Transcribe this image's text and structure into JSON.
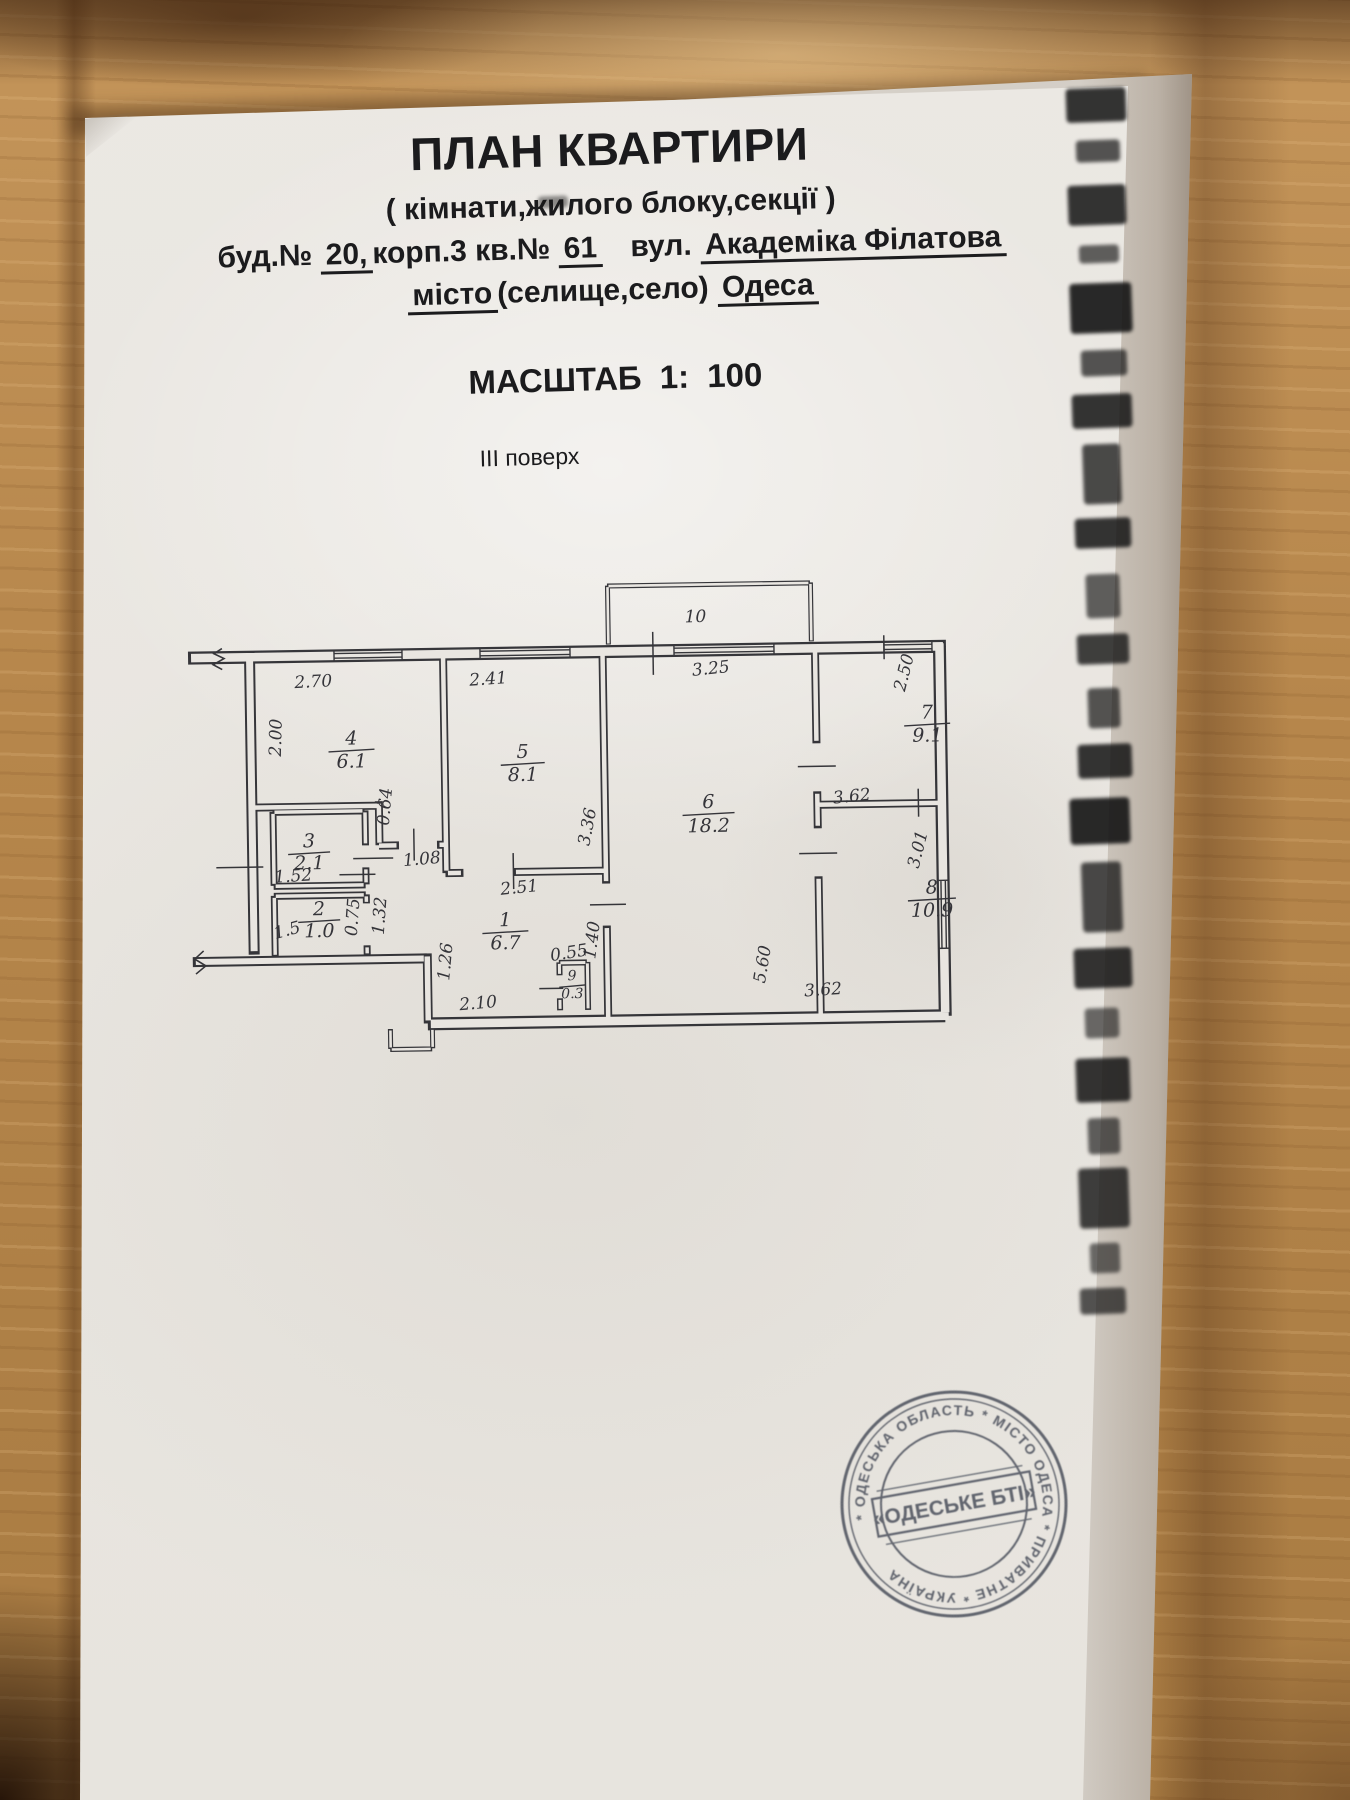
{
  "page": {
    "title": "ПЛАН КВАРТИРИ",
    "subtitle": "( кімнати,жилого блоку,секції )",
    "scale_label": "МАСШТАБ 1: 100",
    "floor_label": "ІІІ поверх"
  },
  "address": {
    "bud_label": "буд.№",
    "house": "20,",
    "building": "корп.3",
    "apt_label": "кв.№",
    "apt": "61",
    "street_label": "вул.",
    "street": "Академіка Філатова",
    "city_label": "місто",
    "city_paren": "(селище,село)",
    "city": "Одеса"
  },
  "plan": {
    "rooms": [
      {
        "number": "1",
        "area": "6.7",
        "x": 503,
        "y": 925,
        "bw": 46,
        "gap": 23
      },
      {
        "number": "2",
        "area": "1.0",
        "x": 317,
        "y": 911,
        "bw": 42,
        "gap": 22
      },
      {
        "number": "3",
        "area": "2.1",
        "x": 308,
        "y": 843,
        "bw": 42,
        "gap": 22
      },
      {
        "number": "4",
        "area": "6.1",
        "x": 352,
        "y": 741,
        "bw": 46,
        "gap": 23
      },
      {
        "number": "5",
        "area": "8.1",
        "x": 523,
        "y": 757,
        "bw": 44,
        "gap": 23
      },
      {
        "number": "6",
        "area": "18.2",
        "x": 708,
        "y": 810,
        "bw": 52,
        "gap": 24
      },
      {
        "number": "7",
        "area": "9.1",
        "x": 928,
        "y": 724,
        "bw": 46,
        "gap": 23
      },
      {
        "number": "8",
        "area": "10.9",
        "x": 930,
        "y": 899,
        "bw": 48,
        "gap": 23
      },
      {
        "number": "9",
        "area": "0.3",
        "x": 569,
        "y": 980,
        "bw": 26,
        "gap": 18,
        "fs": 14
      },
      {
        "number": "10",
        "area": null,
        "x": 698,
        "y": 624,
        "fs": 17
      }
    ],
    "dim_labels": [
      {
        "text": "2.70",
        "x": 315,
        "y": 683,
        "r": -2
      },
      {
        "text": "2.41",
        "x": 490,
        "y": 683,
        "r": -3
      },
      {
        "text": "3.25",
        "x": 713,
        "y": 676,
        "r": -5
      },
      {
        "text": "2.00",
        "x": 282,
        "y": 733,
        "r": -88
      },
      {
        "text": "0.64",
        "x": 390,
        "y": 804,
        "r": -84
      },
      {
        "text": "1.08",
        "x": 421,
        "y": 862,
        "r": -4
      },
      {
        "text": "1.52",
        "x": 292,
        "y": 877,
        "r": -3
      },
      {
        "text": "1.5",
        "x": 286,
        "y": 931,
        "r": -14
      },
      {
        "text": "0.75",
        "x": 356,
        "y": 914,
        "r": -85
      },
      {
        "text": "1.32",
        "x": 383,
        "y": 913,
        "r": -85
      },
      {
        "text": "2.51",
        "x": 518,
        "y": 892,
        "r": -5
      },
      {
        "text": "3.36",
        "x": 592,
        "y": 828,
        "r": -78
      },
      {
        "text": "1.26",
        "x": 448,
        "y": 960,
        "r": -84
      },
      {
        "text": "2.10",
        "x": 475,
        "y": 1007,
        "r": -4
      },
      {
        "text": "0.55",
        "x": 567,
        "y": 958,
        "r": -8
      },
      {
        "text": "1.40",
        "x": 595,
        "y": 941,
        "r": -82
      },
      {
        "text": "5.60",
        "x": 765,
        "y": 968,
        "r": -80
      },
      {
        "text": "3.62",
        "x": 852,
        "y": 806,
        "r": -5
      },
      {
        "text": "3.62",
        "x": 820,
        "y": 999,
        "r": -3
      },
      {
        "text": "2.50",
        "x": 911,
        "y": 679,
        "r": -75
      },
      {
        "text": "3.01",
        "x": 922,
        "y": 856,
        "r": -75
      }
    ]
  },
  "stamp": {
    "ring": "* ОДЕСЬКА ОБЛАСТЬ * МІСТО ОДЕСА * ПРИВАТНЕ * УКРАЇНА",
    "center": "«ОДЕСЬКЕ БТІ»"
  }
}
